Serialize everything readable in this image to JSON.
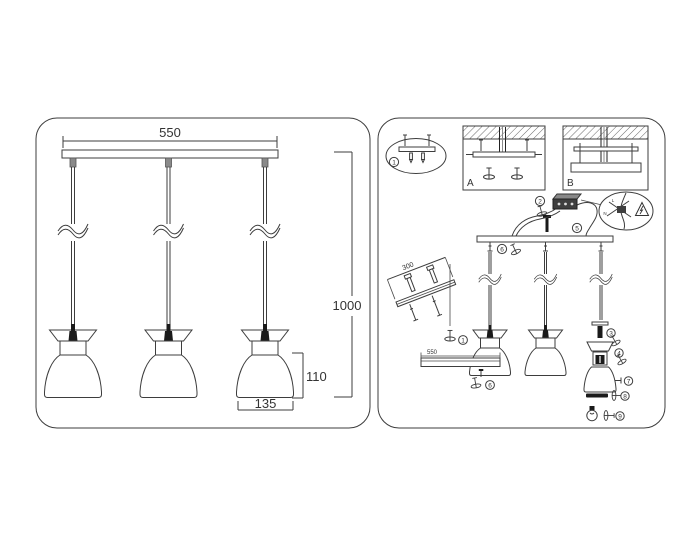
{
  "left_panel": {
    "dimensions": {
      "width": "550",
      "drop_height": "1000",
      "shade_height": "110",
      "shade_diameter": "135"
    }
  },
  "right_panel": {
    "mounting_options": {
      "option_a": "A",
      "option_b": "B"
    },
    "dimensions": {
      "rail_length": "300",
      "canopy_length": "550"
    },
    "wiring_labels": {
      "live": "L",
      "neutral": "N"
    },
    "steps": {
      "s1": "1",
      "s2": "2",
      "s3": "3",
      "s4": "4",
      "s5": "5",
      "s6": "6",
      "s7": "7",
      "s8": "8",
      "s9": "9"
    }
  },
  "colors": {
    "line": "#3d3d3d",
    "ink": "#333333",
    "dark_fill": "#1a1a1a",
    "background": "#ffffff"
  }
}
